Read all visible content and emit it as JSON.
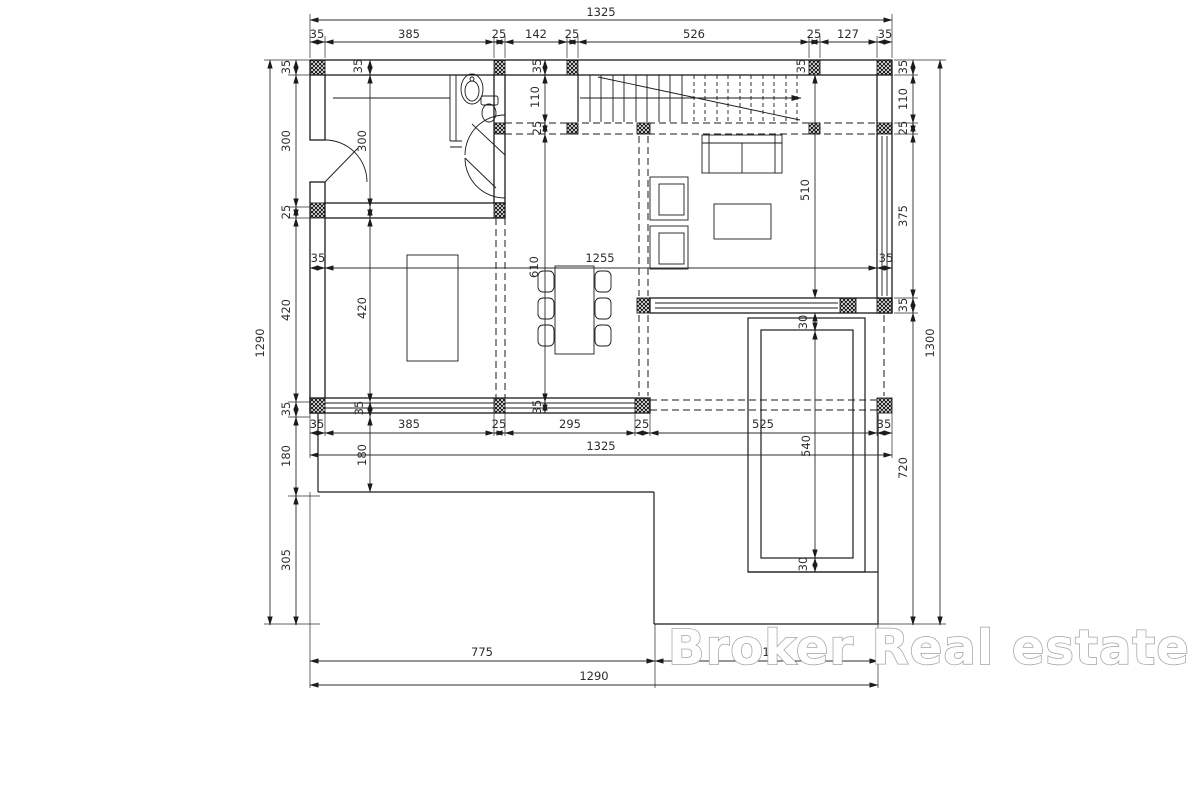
{
  "colors": {
    "background": "#ffffff",
    "line": "#1b1b1b",
    "dim_text": "#2c2c2c",
    "watermark_outline": "#a3a3a3",
    "watermark_fill": "#ffffff"
  },
  "watermark": {
    "text": "Broker Real estate"
  },
  "dimensions": [
    {
      "t": "1325",
      "x": 601,
      "y": 16
    },
    {
      "t": "35",
      "x": 317,
      "y": 38
    },
    {
      "t": "385",
      "x": 409,
      "y": 38
    },
    {
      "t": "25",
      "x": 499,
      "y": 38
    },
    {
      "t": "142",
      "x": 536,
      "y": 38
    },
    {
      "t": "25",
      "x": 572,
      "y": 38
    },
    {
      "t": "526",
      "x": 694,
      "y": 38
    },
    {
      "t": "25",
      "x": 814,
      "y": 38
    },
    {
      "t": "127",
      "x": 848,
      "y": 38
    },
    {
      "t": "35",
      "x": 885,
      "y": 38
    },
    {
      "t": "1290",
      "x": 264,
      "y": 343,
      "r": 1
    },
    {
      "t": "35",
      "x": 290,
      "y": 67,
      "r": 1
    },
    {
      "t": "300",
      "x": 290,
      "y": 141,
      "r": 1
    },
    {
      "t": "25",
      "x": 290,
      "y": 212,
      "r": 1
    },
    {
      "t": "420",
      "x": 290,
      "y": 310,
      "r": 1
    },
    {
      "t": "35",
      "x": 290,
      "y": 409,
      "r": 1
    },
    {
      "t": "180",
      "x": 290,
      "y": 456,
      "r": 1
    },
    {
      "t": "305",
      "x": 290,
      "y": 560,
      "r": 1
    },
    {
      "t": "35",
      "x": 907,
      "y": 67,
      "r": 1
    },
    {
      "t": "110",
      "x": 907,
      "y": 99,
      "r": 1
    },
    {
      "t": "25",
      "x": 907,
      "y": 128,
      "r": 1
    },
    {
      "t": "375",
      "x": 907,
      "y": 216,
      "r": 1
    },
    {
      "t": "35",
      "x": 907,
      "y": 305,
      "r": 1
    },
    {
      "t": "720",
      "x": 907,
      "y": 468,
      "r": 1
    },
    {
      "t": "1300",
      "x": 934,
      "y": 343,
      "r": 1
    },
    {
      "t": "35",
      "x": 317,
      "y": 428
    },
    {
      "t": "385",
      "x": 409,
      "y": 428
    },
    {
      "t": "25",
      "x": 499,
      "y": 428
    },
    {
      "t": "295",
      "x": 570,
      "y": 428
    },
    {
      "t": "25",
      "x": 642,
      "y": 428
    },
    {
      "t": "525",
      "x": 763,
      "y": 428
    },
    {
      "t": "35",
      "x": 884,
      "y": 428
    },
    {
      "t": "1325",
      "x": 601,
      "y": 450
    },
    {
      "t": "775",
      "x": 482,
      "y": 656
    },
    {
      "t": "515",
      "x": 766,
      "y": 656
    },
    {
      "t": "1290",
      "x": 594,
      "y": 680
    },
    {
      "t": "35",
      "x": 362,
      "y": 66,
      "r": 1
    },
    {
      "t": "300",
      "x": 366,
      "y": 141,
      "r": 1
    },
    {
      "t": "420",
      "x": 366,
      "y": 308,
      "r": 1
    },
    {
      "t": "35",
      "x": 363,
      "y": 408,
      "r": 1
    },
    {
      "t": "180",
      "x": 366,
      "y": 455,
      "r": 1
    },
    {
      "t": "35",
      "x": 541,
      "y": 66,
      "r": 1
    },
    {
      "t": "110",
      "x": 539,
      "y": 97,
      "r": 1
    },
    {
      "t": "25",
      "x": 541,
      "y": 128,
      "r": 1
    },
    {
      "t": "610",
      "x": 538,
      "y": 267,
      "r": 1
    },
    {
      "t": "35",
      "x": 541,
      "y": 407,
      "r": 1
    },
    {
      "t": "35",
      "x": 318,
      "y": 262
    },
    {
      "t": "1255",
      "x": 600,
      "y": 262
    },
    {
      "t": "35",
      "x": 886,
      "y": 262
    },
    {
      "t": "510",
      "x": 809,
      "y": 190,
      "r": 1
    },
    {
      "t": "30",
      "x": 807,
      "y": 322,
      "r": 1
    },
    {
      "t": "540",
      "x": 810,
      "y": 446,
      "r": 1
    },
    {
      "t": "30",
      "x": 807,
      "y": 564,
      "r": 1
    },
    {
      "t": "35",
      "x": 805,
      "y": 66,
      "r": 1
    }
  ]
}
